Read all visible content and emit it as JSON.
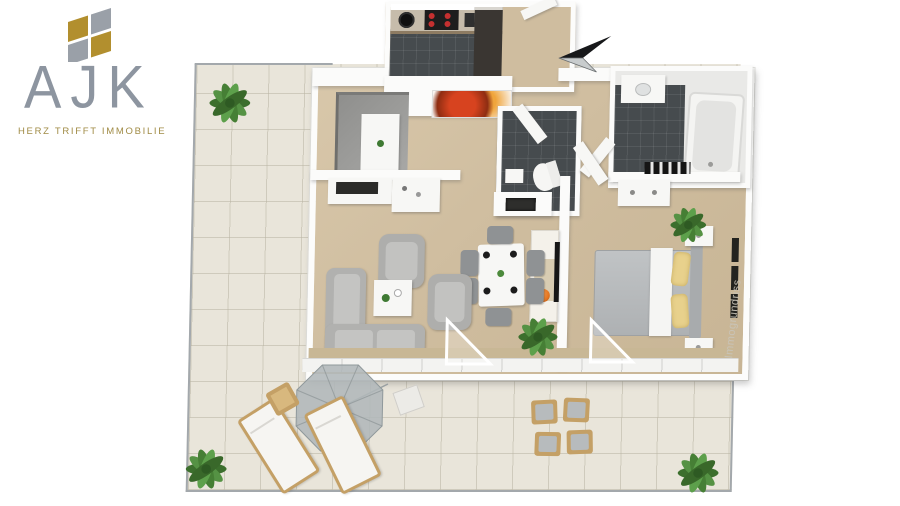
{
  "brand": {
    "letters": "AJK",
    "tagline": "HERZ TRIFFT IMMOBILIE"
  },
  "watermark": {
    "text": "Immogrundriss"
  },
  "icons": {
    "logo_mark": "four-pane-diamond-window",
    "north_arrow": "compass-needle-pointing-left",
    "plant": "green-potted-plant",
    "parasol": "octagonal-garden-umbrella"
  },
  "colors": {
    "logo_gray": "#8d95a0",
    "logo_gold": "#b28f2e",
    "tagline_gold": "#a08b45",
    "terrace_tile": "#e9e5da",
    "railing_gray": "#a3a8ac",
    "apartment_floor_tan": "#cfbd9f",
    "wall_white": "#fbfbfa",
    "dark_tile_floor": "#464b4e",
    "sofa_gray": "#b1b1af",
    "bed_blanket_gray": "#b9bcbe",
    "pillow_yellow": "#e8d18c",
    "outdoor_wood": "#c4a066",
    "plant_green": "#4c8a3c",
    "decor_orange": "#e67722",
    "stove_burner_red": "#c53030",
    "watermark_gray": "#c9c4b8"
  }
}
